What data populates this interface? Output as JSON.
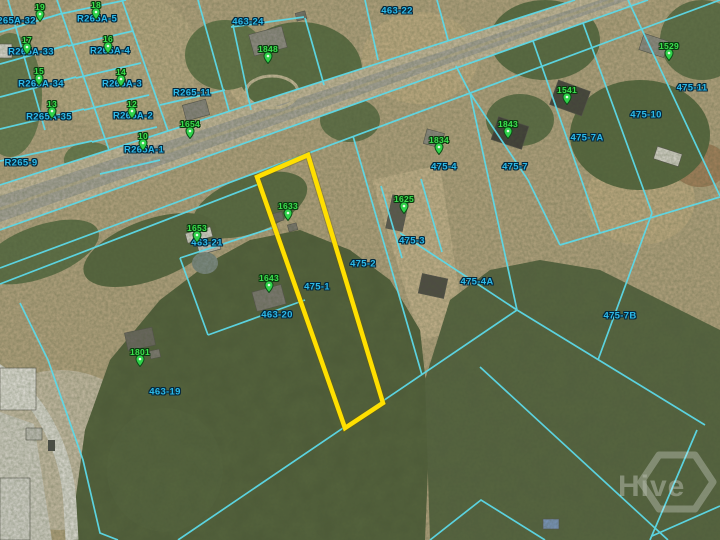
{
  "map": {
    "watermark": {
      "text": "Hive"
    },
    "selected_parcel": {
      "parcel_label": "475-1",
      "address_pin": "1633",
      "outline_color": "#ffdf00"
    },
    "colors": {
      "parcel_line": "#5cd9e8",
      "parcel_label_text": "#2cb9e8",
      "pin_label_text": "#3ce04e",
      "pin_fill": "#2fd24a",
      "pin_stroke": "#0c4d16",
      "highlight": "#ffdf00"
    },
    "parcel_labels": [
      {
        "text": "R265A-32",
        "x": 13,
        "y": 21
      },
      {
        "text": "R265A-5",
        "x": 97,
        "y": 19
      },
      {
        "text": "R265A-33",
        "x": 31,
        "y": 52
      },
      {
        "text": "R265A-4",
        "x": 110,
        "y": 51
      },
      {
        "text": "R265A-34",
        "x": 41,
        "y": 84
      },
      {
        "text": "R265A-3",
        "x": 122,
        "y": 84
      },
      {
        "text": "R265A-35",
        "x": 49,
        "y": 117
      },
      {
        "text": "R265A-2",
        "x": 133,
        "y": 116
      },
      {
        "text": "R265A-1",
        "x": 144,
        "y": 150
      },
      {
        "text": "R265-11",
        "x": 192,
        "y": 93
      },
      {
        "text": "R265-9",
        "x": 21,
        "y": 163
      },
      {
        "text": "463-24",
        "x": 248,
        "y": 22
      },
      {
        "text": "463-22",
        "x": 397,
        "y": 11
      },
      {
        "text": "463-21",
        "x": 207,
        "y": 243
      },
      {
        "text": "463-20",
        "x": 277,
        "y": 315
      },
      {
        "text": "463-19",
        "x": 165,
        "y": 392
      },
      {
        "text": "475-1",
        "x": 317,
        "y": 287
      },
      {
        "text": "475-2",
        "x": 363,
        "y": 264
      },
      {
        "text": "475-3",
        "x": 412,
        "y": 241
      },
      {
        "text": "475-4",
        "x": 444,
        "y": 167
      },
      {
        "text": "475-4A",
        "x": 477,
        "y": 282
      },
      {
        "text": "475-7",
        "x": 515,
        "y": 167
      },
      {
        "text": "475-7A",
        "x": 587,
        "y": 138
      },
      {
        "text": "475-7B",
        "x": 620,
        "y": 316
      },
      {
        "text": "475-10",
        "x": 646,
        "y": 115
      },
      {
        "text": "475-11",
        "x": 692,
        "y": 88
      }
    ],
    "address_pins": [
      {
        "text": "19",
        "x": 40,
        "y": 7
      },
      {
        "text": "18",
        "x": 96,
        "y": 5
      },
      {
        "text": "17",
        "x": 27,
        "y": 40
      },
      {
        "text": "16",
        "x": 108,
        "y": 39
      },
      {
        "text": "15",
        "x": 39,
        "y": 71
      },
      {
        "text": "14",
        "x": 121,
        "y": 72
      },
      {
        "text": "13",
        "x": 52,
        "y": 104
      },
      {
        "text": "12",
        "x": 132,
        "y": 104
      },
      {
        "text": "10",
        "x": 143,
        "y": 136
      },
      {
        "text": "1654",
        "x": 190,
        "y": 124
      },
      {
        "text": "1848",
        "x": 268,
        "y": 49
      },
      {
        "text": "1834",
        "x": 439,
        "y": 140
      },
      {
        "text": "1843",
        "x": 508,
        "y": 124
      },
      {
        "text": "1541",
        "x": 567,
        "y": 90
      },
      {
        "text": "1529",
        "x": 669,
        "y": 46
      },
      {
        "text": "1653",
        "x": 197,
        "y": 228
      },
      {
        "text": "1633",
        "x": 288,
        "y": 206
      },
      {
        "text": "1625",
        "x": 404,
        "y": 199
      },
      {
        "text": "1643",
        "x": 269,
        "y": 278
      },
      {
        "text": "1801",
        "x": 140,
        "y": 352
      }
    ]
  }
}
